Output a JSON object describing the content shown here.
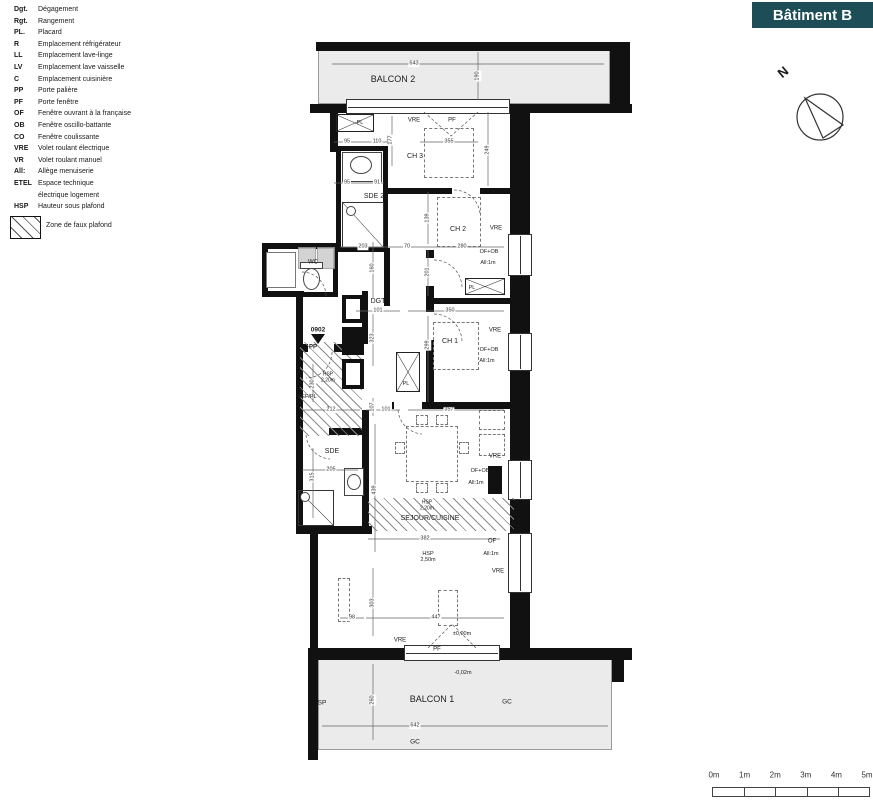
{
  "legend": {
    "items": [
      {
        "abbr": "Dgt.",
        "label": "Dégagement"
      },
      {
        "abbr": "Rgt.",
        "label": "Rangement"
      },
      {
        "abbr": "PL.",
        "label": "Placard"
      },
      {
        "abbr": "R",
        "label": "Emplacement réfrigérateur"
      },
      {
        "abbr": "LL",
        "label": "Emplacement lave-linge"
      },
      {
        "abbr": "LV",
        "label": "Emplacement lave vaisselle"
      },
      {
        "abbr": "C",
        "label": "Emplacement cuisinière"
      },
      {
        "abbr": "PP",
        "label": "Porte palière"
      },
      {
        "abbr": "PF",
        "label": "Porte fenêtre"
      },
      {
        "abbr": "OF",
        "label": "Fenêtre ouvrant à la française"
      },
      {
        "abbr": "OB",
        "label": "Fenêtre oscillo-battante"
      },
      {
        "abbr": "CO",
        "label": "Fenêtre coulissante"
      },
      {
        "abbr": "VRE",
        "label": "Volet roulant électrique"
      },
      {
        "abbr": "VR",
        "label": "Volet roulant manuel"
      },
      {
        "abbr": "All:",
        "label": "Allège menuiserie"
      },
      {
        "abbr": "ETEL",
        "label": "Espace technique\nélectrique logement"
      },
      {
        "abbr": "HSP",
        "label": "Hauteur sous plafond"
      }
    ],
    "zone_label": "Zone de faux plafond"
  },
  "building": {
    "label": "Bâtiment B",
    "color": "#1d4e57"
  },
  "compass": {
    "label": "N"
  },
  "scale_bar": {
    "labels": [
      "0m",
      "1m",
      "2m",
      "3m",
      "4m",
      "5m"
    ]
  },
  "plan": {
    "labels": [
      {
        "text": "BALCON 2",
        "x": 393,
        "y": 80,
        "s": 9
      },
      {
        "text": "CH 3",
        "x": 415,
        "y": 157,
        "s": 7
      },
      {
        "text": "SDE 2",
        "x": 374,
        "y": 197,
        "s": 7
      },
      {
        "text": "CH 2",
        "x": 458,
        "y": 230,
        "s": 7
      },
      {
        "text": "WC",
        "x": 313,
        "y": 263,
        "s": 6
      },
      {
        "text": "DGT",
        "x": 378,
        "y": 302,
        "s": 7
      },
      {
        "text": "CH 1",
        "x": 450,
        "y": 342,
        "s": 7
      },
      {
        "text": "SDE",
        "x": 332,
        "y": 452,
        "s": 7
      },
      {
        "text": "SEJOUR/CUISINE",
        "x": 430,
        "y": 519,
        "s": 7
      },
      {
        "text": "BALCON 1",
        "x": 432,
        "y": 700,
        "s": 9
      },
      {
        "text": "REF/PL",
        "x": 307,
        "y": 397,
        "s": 5.5
      },
      {
        "text": "PL",
        "x": 360,
        "y": 123,
        "s": 5.5
      },
      {
        "text": "PL",
        "x": 406,
        "y": 384,
        "s": 5.5
      },
      {
        "text": "PL",
        "x": 472,
        "y": 288,
        "s": 5.5
      },
      {
        "text": "PP",
        "x": 313,
        "y": 348,
        "s": 6,
        "b": 1
      },
      {
        "text": "0902",
        "x": 318,
        "y": 330,
        "s": 6.5,
        "b": 1
      },
      {
        "text": "VRE",
        "x": 414,
        "y": 121,
        "s": 6
      },
      {
        "text": "PF",
        "x": 452,
        "y": 121,
        "s": 6
      },
      {
        "text": "VRE",
        "x": 496,
        "y": 229,
        "s": 6
      },
      {
        "text": "OF+OB",
        "x": 489,
        "y": 252,
        "s": 5.5
      },
      {
        "text": "All:1m",
        "x": 488,
        "y": 263,
        "s": 5.5
      },
      {
        "text": "VRE",
        "x": 495,
        "y": 331,
        "s": 6
      },
      {
        "text": "OF+OB",
        "x": 489,
        "y": 350,
        "s": 5.5
      },
      {
        "text": "All:1m",
        "x": 487,
        "y": 361,
        "s": 5.5
      },
      {
        "text": "VRE",
        "x": 495,
        "y": 457,
        "s": 6
      },
      {
        "text": "OF+OB",
        "x": 480,
        "y": 471,
        "s": 5.5
      },
      {
        "text": "All:1m",
        "x": 476,
        "y": 483,
        "s": 5.5
      },
      {
        "text": "OF",
        "x": 492,
        "y": 542,
        "s": 6
      },
      {
        "text": "All:1m",
        "x": 491,
        "y": 554,
        "s": 5.5
      },
      {
        "text": "VRE",
        "x": 498,
        "y": 572,
        "s": 6
      },
      {
        "text": "VRE",
        "x": 400,
        "y": 641,
        "s": 6
      },
      {
        "text": "PF",
        "x": 437,
        "y": 650,
        "s": 6
      },
      {
        "text": "±0,00m",
        "x": 462,
        "y": 634,
        "s": 5.5
      },
      {
        "text": "-0,02m",
        "x": 463,
        "y": 673,
        "s": 5.5
      },
      {
        "text": "HSP\n2,20m",
        "x": 328,
        "y": 378,
        "s": 5
      },
      {
        "text": "HSP\n2,20m",
        "x": 427,
        "y": 506,
        "s": 5
      },
      {
        "text": "HSP\n2,50m",
        "x": 428,
        "y": 557,
        "s": 5.5
      },
      {
        "text": "SP",
        "x": 322,
        "y": 703,
        "s": 6.5
      },
      {
        "text": "GC",
        "x": 507,
        "y": 702,
        "s": 6.5
      },
      {
        "text": "GC",
        "x": 415,
        "y": 742,
        "s": 6.5
      }
    ],
    "dims": [
      {
        "t": "643",
        "x": 414,
        "y": 64
      },
      {
        "t": "190",
        "x": 478,
        "y": 76,
        "r": 1
      },
      {
        "t": "95",
        "x": 347,
        "y": 142
      },
      {
        "t": "110",
        "x": 377,
        "y": 142
      },
      {
        "t": "177",
        "x": 391,
        "y": 140,
        "r": 1
      },
      {
        "t": "355",
        "x": 449,
        "y": 142
      },
      {
        "t": "249",
        "x": 488,
        "y": 150,
        "r": 1
      },
      {
        "t": "95",
        "x": 347,
        "y": 183
      },
      {
        "t": "91",
        "x": 377,
        "y": 183
      },
      {
        "t": "203",
        "x": 363,
        "y": 247
      },
      {
        "t": "70",
        "x": 407,
        "y": 247
      },
      {
        "t": "280",
        "x": 462,
        "y": 247
      },
      {
        "t": "139",
        "x": 428,
        "y": 218,
        "r": 1
      },
      {
        "t": "201",
        "x": 428,
        "y": 272,
        "r": 1
      },
      {
        "t": "160",
        "x": 373,
        "y": 268,
        "r": 1
      },
      {
        "t": "101",
        "x": 378,
        "y": 311
      },
      {
        "t": "350",
        "x": 450,
        "y": 311
      },
      {
        "t": "323",
        "x": 373,
        "y": 338,
        "r": 1
      },
      {
        "t": "299",
        "x": 428,
        "y": 345,
        "r": 1
      },
      {
        "t": "230",
        "x": 313,
        "y": 384,
        "r": 1
      },
      {
        "t": "212",
        "x": 331,
        "y": 410
      },
      {
        "t": "107",
        "x": 373,
        "y": 407,
        "r": 1
      },
      {
        "t": "101",
        "x": 386,
        "y": 410
      },
      {
        "t": "357",
        "x": 449,
        "y": 410
      },
      {
        "t": "205",
        "x": 331,
        "y": 470
      },
      {
        "t": "315",
        "x": 313,
        "y": 477,
        "r": 1
      },
      {
        "t": "439",
        "x": 375,
        "y": 490,
        "r": 1
      },
      {
        "t": "382",
        "x": 425,
        "y": 539
      },
      {
        "t": "303",
        "x": 373,
        "y": 603,
        "r": 1
      },
      {
        "t": "98",
        "x": 352,
        "y": 618
      },
      {
        "t": "447",
        "x": 436,
        "y": 618
      },
      {
        "t": "642",
        "x": 415,
        "y": 726
      },
      {
        "t": "260",
        "x": 373,
        "y": 700,
        "r": 1
      }
    ]
  }
}
